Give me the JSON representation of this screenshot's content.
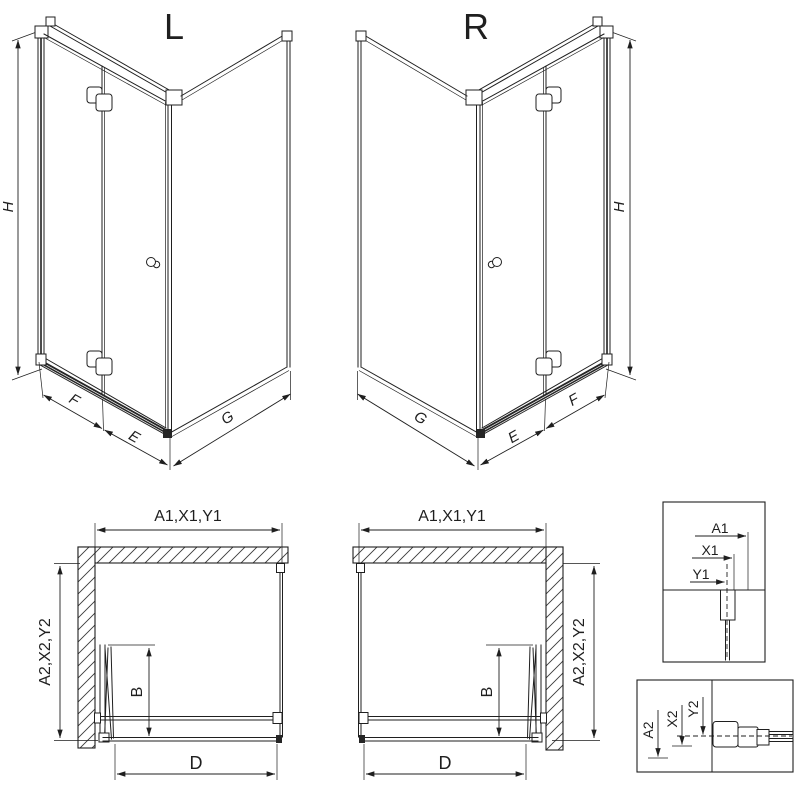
{
  "drawing": {
    "colors": {
      "line": "#1f1f1f",
      "background": "#ffffff"
    },
    "iso_left": {
      "title": "L",
      "dim_height": "H",
      "dim_fixed": "F",
      "dim_entry": "E",
      "dim_side": "G"
    },
    "iso_right": {
      "title": "R",
      "dim_height": "H",
      "dim_fixed": "F",
      "dim_entry": "E",
      "dim_side": "G"
    },
    "plan_left": {
      "dim_width": "A1,X1,Y1",
      "dim_depth": "A2,X2,Y2",
      "dim_door": "B",
      "dim_opening": "D"
    },
    "plan_right": {
      "dim_width": "A1,X1,Y1",
      "dim_depth": "A2,X2,Y2",
      "dim_door": "B",
      "dim_opening": "D"
    },
    "detail_width": {
      "dim_a": "A1",
      "dim_x": "X1",
      "dim_y": "Y1"
    },
    "detail_depth": {
      "dim_a": "A2",
      "dim_x": "X2",
      "dim_y": "Y2"
    }
  }
}
